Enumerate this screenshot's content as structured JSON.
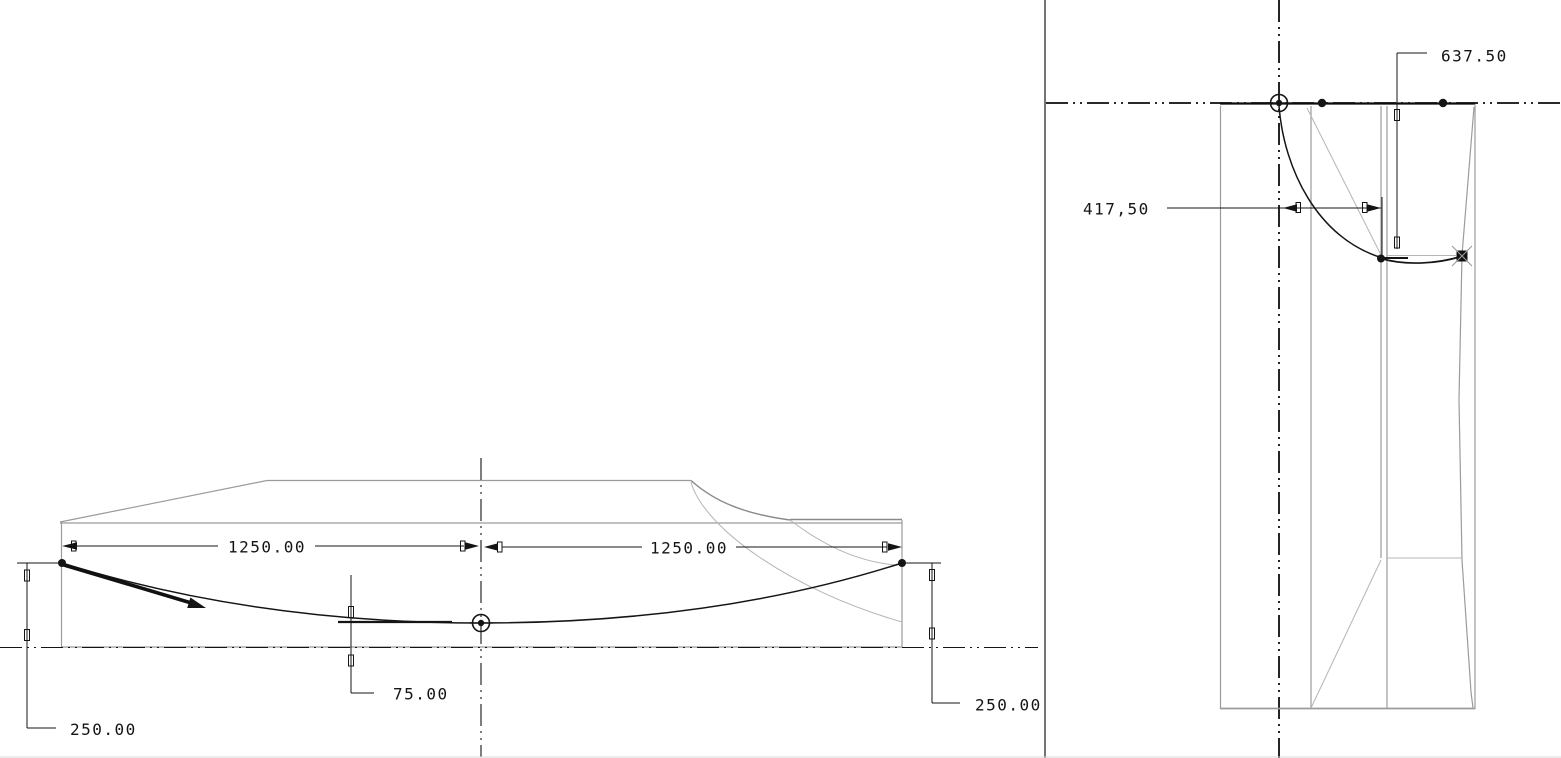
{
  "canvas": {
    "width": 1561,
    "height": 758,
    "background": "#ffffff"
  },
  "colors": {
    "sketch_line": "#151515",
    "model_edge": "#9b9b9b",
    "model_edge_light": "#b5b5b5",
    "dimension": "#141414",
    "viewport_border": "#2a2a2a"
  },
  "left_view": {
    "dimensions": {
      "span_left": "1250.00",
      "span_right": "1250.00",
      "sag_depth": "75.00",
      "end_height_left": "250.00",
      "end_height_right": "250.00"
    }
  },
  "right_view": {
    "dimensions": {
      "vertical_extent": "637.50",
      "horizontal_offset": "417,50"
    }
  }
}
